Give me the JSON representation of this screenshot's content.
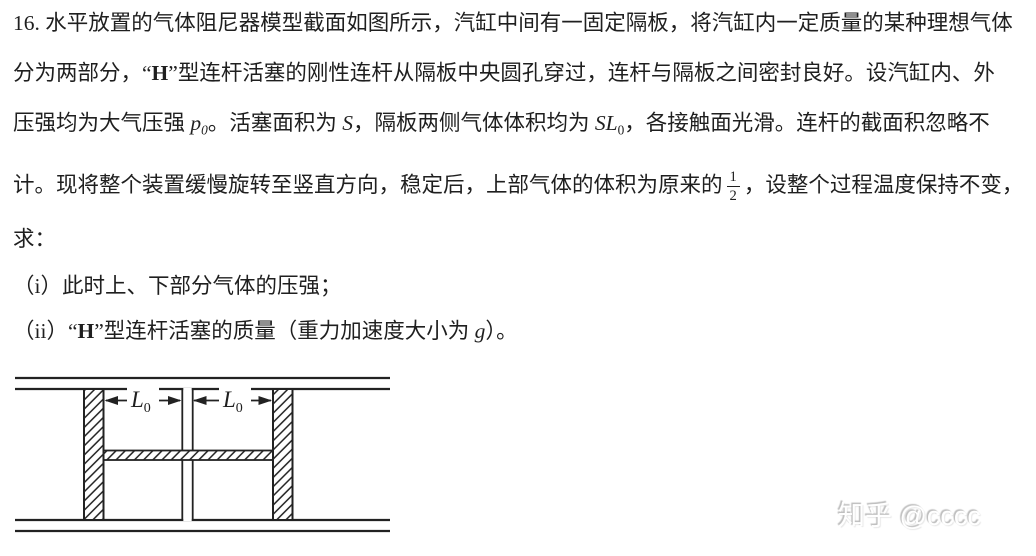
{
  "problem": {
    "lines": [
      {
        "segments": [
          {
            "t": "text",
            "v": "16. 水平放置的气体阻尼器模型截面如图所示，汽缸中间有一固定隔板，将汽缸内一定质量的某种理想气体"
          }
        ]
      },
      {
        "segments": [
          {
            "t": "text",
            "v": "分为两部分，“"
          },
          {
            "t": "b",
            "v": "H"
          },
          {
            "t": "text",
            "v": "”型连杆活塞的刚性连杆从隔板中央圆孔穿过，连杆与隔板之间密封良好。设汽缸内、外"
          }
        ]
      },
      {
        "segments": [
          {
            "t": "text",
            "v": "压强均为大气压强 "
          },
          {
            "t": "i",
            "v": "p"
          },
          {
            "t": "isub",
            "v": "0"
          },
          {
            "t": "text",
            "v": "。活塞面积为 "
          },
          {
            "t": "i",
            "v": "S"
          },
          {
            "t": "text",
            "v": "，隔板两侧气体体积均为 "
          },
          {
            "t": "i",
            "v": "SL"
          },
          {
            "t": "sub",
            "v": "0"
          },
          {
            "t": "text",
            "v": "，各接触面光滑。连杆的截面积忽略不"
          }
        ]
      },
      {
        "segments": [
          {
            "t": "text",
            "v": "计。现将整个装置缓慢旋转至竖直方向，稳定后，上部气体的体积为原来的"
          },
          {
            "t": "frac",
            "n": "1",
            "d": "2"
          },
          {
            "t": "text",
            "v": "，设整个过程温度保持不变，"
          }
        ]
      },
      {
        "segments": [
          {
            "t": "text",
            "v": "求："
          }
        ]
      },
      {
        "segments": [
          {
            "t": "text",
            "v": "（i）此时上、下部分气体的压强；"
          }
        ]
      },
      {
        "segments": [
          {
            "t": "text",
            "v": "（ii）“"
          },
          {
            "t": "b",
            "v": "H"
          },
          {
            "t": "text",
            "v": "”型连杆活塞的质量（重力加速度大小为 "
          },
          {
            "t": "i",
            "v": "g"
          },
          {
            "t": "text",
            "v": "）。"
          }
        ]
      }
    ]
  },
  "diagram": {
    "label_main": "L",
    "label_sub": "0",
    "line_color": "#222222"
  },
  "watermark": {
    "text": "知乎 @cccc"
  }
}
